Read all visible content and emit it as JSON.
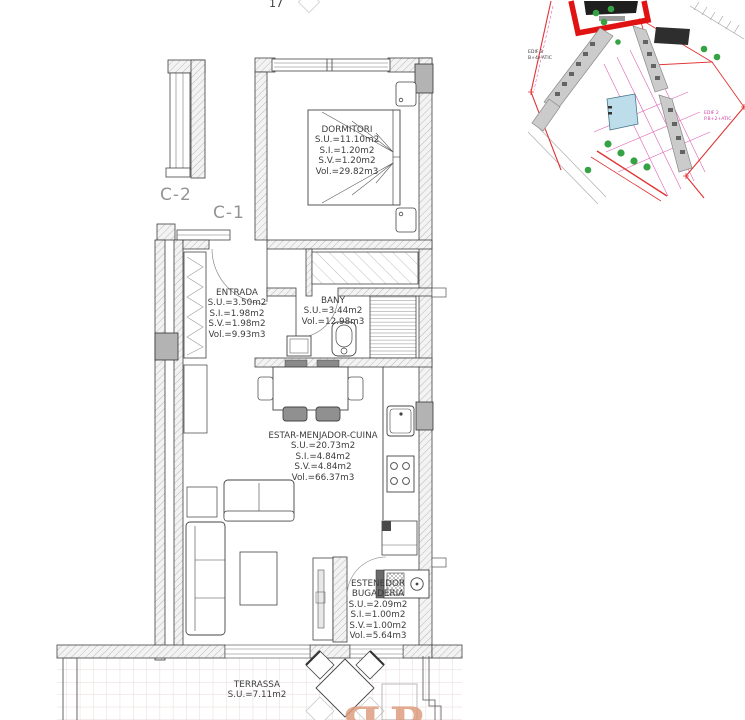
{
  "sheet": {
    "number": "17",
    "watermark": "ЯR"
  },
  "unit_labels": {
    "c1": "C-1",
    "c2": "C-2"
  },
  "rooms": {
    "dormitori": {
      "name": "DORMITORI",
      "lines": [
        "S.U.=11.10m2",
        "S.I.=1.20m2",
        "S.V.=1.20m2",
        "Vol.=29.82m3"
      ]
    },
    "entrada": {
      "name": "ENTRADA",
      "lines": [
        "S.U.=3.50m2",
        "S.I.=1.98m2",
        "S.V.=1.98m2",
        "Vol.=9.93m3"
      ]
    },
    "bany": {
      "name": "BANY",
      "lines": [
        "S.U.=3.44m2",
        "Vol.=12.98m3"
      ]
    },
    "estar_menjador_cuina": {
      "name": "ESTAR-MENJADOR-CUINA",
      "lines": [
        "S.U.=20.73m2",
        "S.I.=4.84m2",
        "S.V.=4.84m2",
        "Vol.=66.37m3"
      ]
    },
    "estenedor_bugaderia": {
      "name": "ESTENEDOR",
      "name2": "BUGADERIA",
      "lines": [
        "S.U.=2.09m2",
        "S.I.=1.00m2",
        "S.V.=1.00m2",
        "Vol.=5.64m3"
      ]
    },
    "terrassa": {
      "name": "TERRASSA",
      "lines": [
        "S.U.=7.11m2"
      ]
    }
  },
  "site_plan": {
    "edif2": {
      "name": "EDIF 2",
      "spec": "P.B+2+ATIC"
    },
    "edif3": {
      "name": "EDIF 3",
      "spec": "B+4+ATIC"
    }
  },
  "colors": {
    "highlight_red": "#e01212",
    "boundary_red": "#e03434",
    "road_magenta": "#e060b2",
    "vegetation_green": "#35a244",
    "pool_blue": "#bcdde9",
    "building_gray": "#cbcbcb",
    "pillar_gray": "#b3b3b3",
    "watermark_salmon": "#dd9878",
    "unit_label_gray": "#949494",
    "text_dark": "#3d3d3d"
  }
}
